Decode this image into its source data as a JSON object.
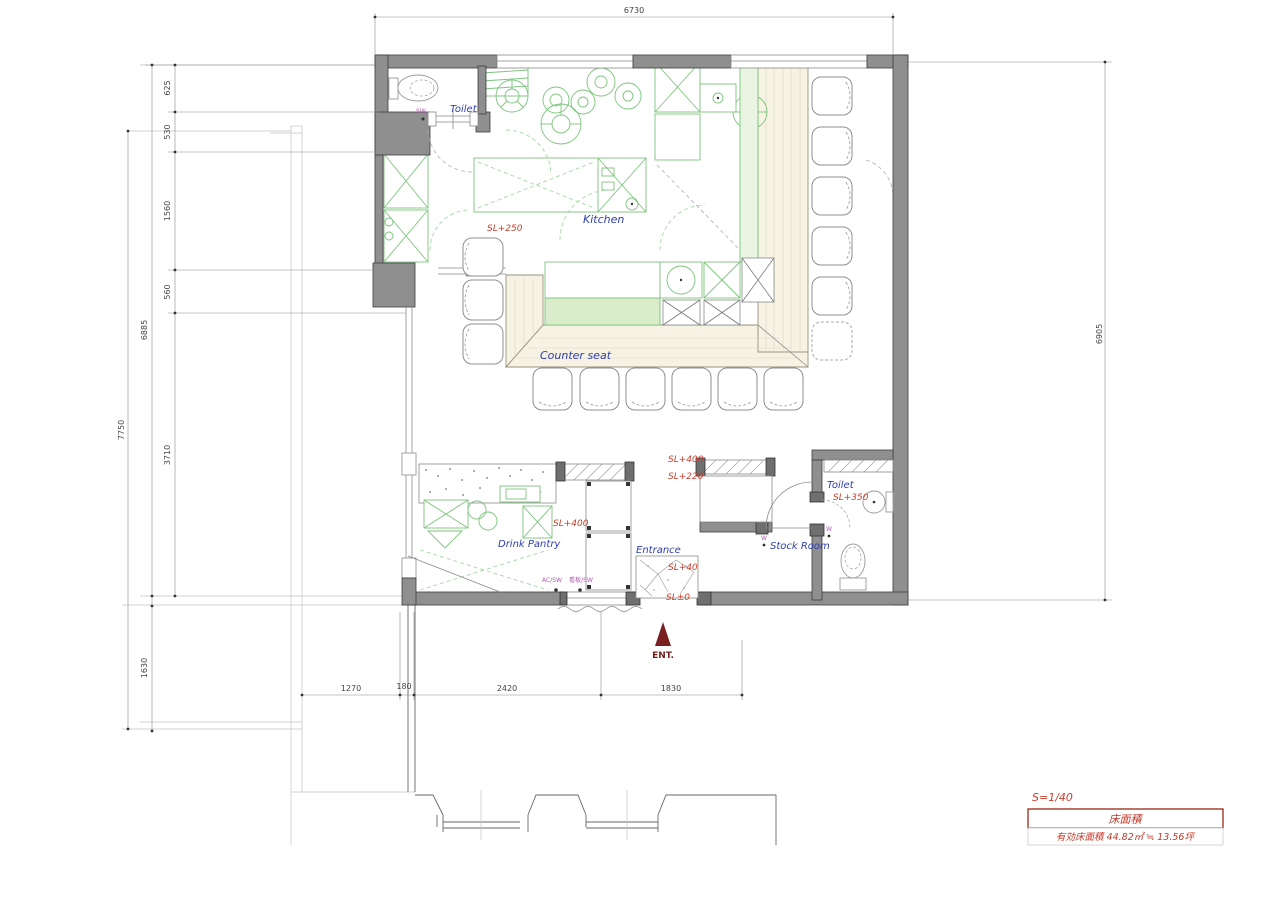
{
  "drawing": {
    "rooms": {
      "toilet1": "Toilet",
      "kitchen": "Kitchen",
      "counter_seat": "Counter seat",
      "drink_pantry": "Drink Pantry",
      "entrance": "Entrance",
      "stock_room": "Stock Room",
      "toilet2": "Toilet"
    },
    "levels": {
      "kitchen": "SL+250",
      "hall_upper": "SL+400",
      "hall_lower": "SL+220",
      "pantry": "SL+400",
      "entrance_step": "SL+40",
      "ground": "SL±0",
      "toilet2": "SL+350"
    },
    "entrance_marker": "ENT.",
    "switch_marks": {
      "toilet_sw": "SW",
      "ac_sw": "AC/SW",
      "sign_sw": "看板/SW",
      "w_stock": "W",
      "w_toilet": "W"
    },
    "dimensions": {
      "top": "6730",
      "right": "6905",
      "left": {
        "d625": "625",
        "d530": "530",
        "d1560": "1560",
        "d560": "560",
        "d6885": "6885",
        "d7750": "7750",
        "d3710": "3710",
        "d1630": "1630"
      },
      "bottom": {
        "d1270": "1270",
        "d180": "180",
        "d2420": "2420",
        "d1830": "1830"
      }
    },
    "title_block": {
      "scale": "S=1/40",
      "area_title": "床面積",
      "area_value": "有効床面積 44.82㎡ ≒ 13.56坪"
    },
    "colors": {
      "wall_gray": "#8f8f8f",
      "equipment_green": "#7cc47c",
      "wood_counter": "#f6f2e4",
      "label_blue": "#2e3fae",
      "label_red": "#c8402e",
      "entrance_red": "#7a1f1f",
      "switch_magenta": "#b05ab0",
      "dimension_gray": "#444444"
    }
  }
}
